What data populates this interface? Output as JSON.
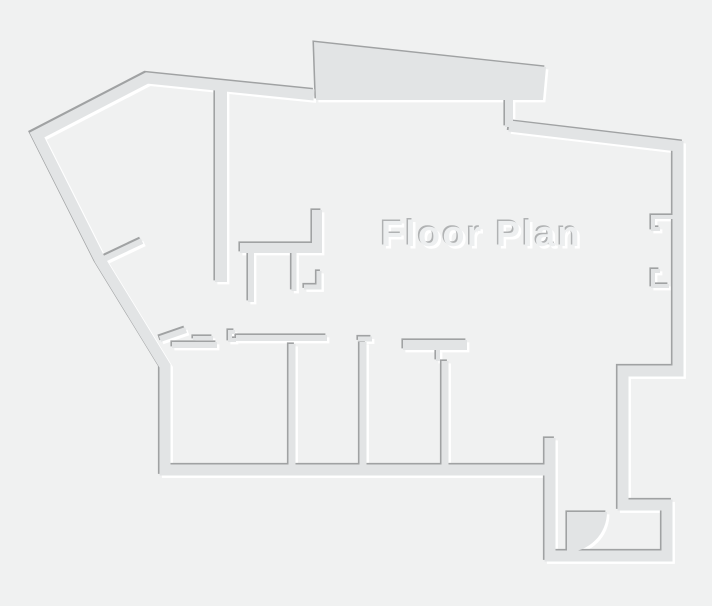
{
  "title": "Floor Plan",
  "canvas": {
    "width": 712,
    "height": 606
  },
  "colors": {
    "background": "#f0f1f1",
    "wall": "#e2e4e5",
    "wall_shadow": "#a0a2a3",
    "wall_highlight": "#ffffff",
    "title_fill": "#edeff0",
    "title_shadow": "#b0b2b3",
    "title_highlight": "#ffffff"
  },
  "floorplan": {
    "emboss": {
      "highlight_offset": 2.4,
      "shadow_offset": -1.6
    },
    "walls": [
      {
        "name": "outer-wall-west-north",
        "width": 11,
        "points": [
          [
            314,
            95
          ],
          [
            147,
            78
          ],
          [
            37,
            135
          ],
          [
            100,
            260
          ],
          [
            165,
            366
          ],
          [
            165,
            470
          ],
          [
            553,
            470
          ]
        ]
      },
      {
        "name": "outer-wall-east-entry",
        "width": 11,
        "points": [
          [
            509,
            126
          ],
          [
            678,
            146
          ],
          [
            678,
            371
          ],
          [
            623,
            371
          ],
          [
            623,
            505
          ],
          [
            667,
            505
          ],
          [
            667,
            556
          ],
          [
            550,
            556
          ],
          [
            550,
            438
          ]
        ]
      },
      {
        "name": "canopy-connector-wall",
        "width": 8,
        "points": [
          [
            509,
            97
          ],
          [
            509,
            127
          ]
        ]
      },
      {
        "name": "hall-partition-wall",
        "width": 12,
        "points": [
          [
            221,
            90
          ],
          [
            221,
            282
          ]
        ]
      },
      {
        "name": "core-l-wall",
        "width": 10,
        "points": [
          [
            317,
            210
          ],
          [
            317,
            248
          ],
          [
            240,
            248
          ]
        ]
      },
      {
        "name": "core-stub-west",
        "width": 6,
        "points": [
          [
            251,
            253
          ],
          [
            251,
            302
          ]
        ]
      },
      {
        "name": "core-stub-east",
        "width": 5,
        "points": [
          [
            294,
            253
          ],
          [
            294,
            291
          ]
        ]
      },
      {
        "name": "core-corner-stub",
        "width": 5,
        "points": [
          [
            319,
            271
          ],
          [
            319,
            287
          ],
          [
            304,
            287
          ]
        ]
      },
      {
        "name": "west-door-jamb",
        "width": 6,
        "points": [
          [
            104,
            259
          ],
          [
            142,
            241
          ]
        ]
      },
      {
        "name": "room1-diagonal-jamb",
        "width": 6,
        "points": [
          [
            160,
            339
          ],
          [
            186,
            330
          ]
        ]
      },
      {
        "name": "room1-top-wall",
        "width": 6,
        "points": [
          [
            172,
            345
          ],
          [
            217,
            345
          ]
        ]
      },
      {
        "name": "room1-door-leaf",
        "width": 4,
        "points": [
          [
            193,
            338
          ],
          [
            213,
            338
          ]
        ]
      },
      {
        "name": "room2-door-jamb",
        "width": 4,
        "points": [
          [
            235,
            332
          ],
          [
            230,
            332
          ],
          [
            230,
            340
          ],
          [
            236,
            340
          ]
        ]
      },
      {
        "name": "room2-top-wall",
        "width": 6,
        "points": [
          [
            236,
            338
          ],
          [
            327,
            338
          ]
        ]
      },
      {
        "name": "partition-a",
        "width": 7,
        "points": [
          [
            292,
            344
          ],
          [
            292,
            466
          ]
        ]
      },
      {
        "name": "partition-b-stub",
        "width": 5,
        "points": [
          [
            358,
            339
          ],
          [
            372,
            339
          ]
        ]
      },
      {
        "name": "partition-b",
        "width": 7,
        "points": [
          [
            363,
            342
          ],
          [
            363,
            466
          ]
        ]
      },
      {
        "name": "room4-top-wall",
        "width": 10,
        "points": [
          [
            403,
            345
          ],
          [
            467,
            345
          ]
        ]
      },
      {
        "name": "partition-c-jamb",
        "width": 4,
        "points": [
          [
            438,
            350
          ],
          [
            438,
            361
          ]
        ]
      },
      {
        "name": "partition-c",
        "width": 7,
        "points": [
          [
            445,
            361
          ],
          [
            445,
            466
          ]
        ]
      },
      {
        "name": "window-notch-north",
        "width": 4,
        "points": [
          [
            676,
            217
          ],
          [
            653,
            217
          ],
          [
            653,
            229
          ],
          [
            660,
            229
          ]
        ]
      },
      {
        "name": "window-notch-south",
        "width": 4,
        "points": [
          [
            660,
            271
          ],
          [
            653,
            271
          ],
          [
            653,
            286
          ],
          [
            669,
            286
          ]
        ]
      }
    ],
    "fills": [
      {
        "name": "canopy-slab",
        "path": "M314,42 L546,67 L543,100 L316,100 Z"
      },
      {
        "name": "entry-door-swing",
        "path": "M567,512 L607,512 A40,40 0 0 1 567,552 Z"
      }
    ]
  }
}
